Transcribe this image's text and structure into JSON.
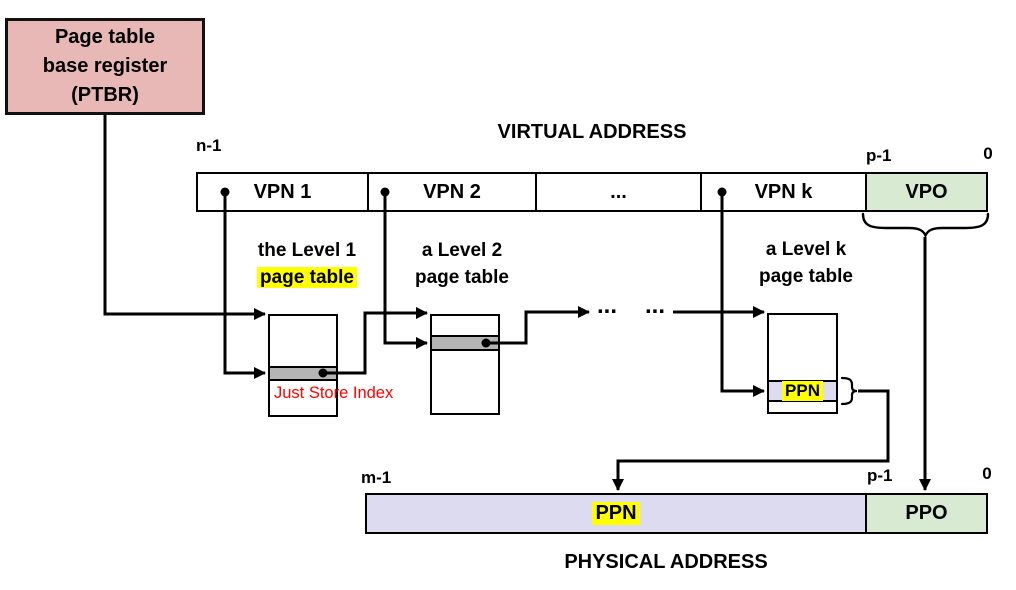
{
  "ptbr": {
    "line1": "Page table",
    "line2": "base register",
    "line3": "(PTBR)"
  },
  "virtual_address": {
    "title": "VIRTUAL ADDRESS",
    "bit_left": "n-1",
    "bit_p": "p-1",
    "bit_zero": "0",
    "fields": [
      "VPN 1",
      "VPN 2",
      "...",
      "VPN k",
      "VPO"
    ]
  },
  "page_tables": {
    "level1": {
      "caption_line1": "the Level 1",
      "caption_line2": "page table",
      "caption_line2_highlighted": true
    },
    "level2": {
      "caption_line1": "a Level 2",
      "caption_line2": "page table"
    },
    "levelk": {
      "caption_line1": "a Level k",
      "caption_line2": "page table",
      "entry_label": "PPN"
    }
  },
  "annotation": {
    "text": "Just Store Index",
    "color": "#ff0000"
  },
  "flow": {
    "ellipsis1": "...",
    "ellipsis2": "..."
  },
  "physical_address": {
    "title": "PHYSICAL ADDRESS",
    "bit_left": "m-1",
    "bit_p": "p-1",
    "bit_zero": "0",
    "fields": [
      "PPN",
      "PPO"
    ]
  },
  "colors": {
    "ptbr_fill": "#e7b8b5",
    "offset_green": "#d9ead3",
    "ppn_lavender": "#dcdbf0",
    "entry_gray": "#b5b5b5",
    "highlight_yellow": "#ffff00",
    "annotation_red": "#ff0000",
    "line_black": "#000000"
  }
}
